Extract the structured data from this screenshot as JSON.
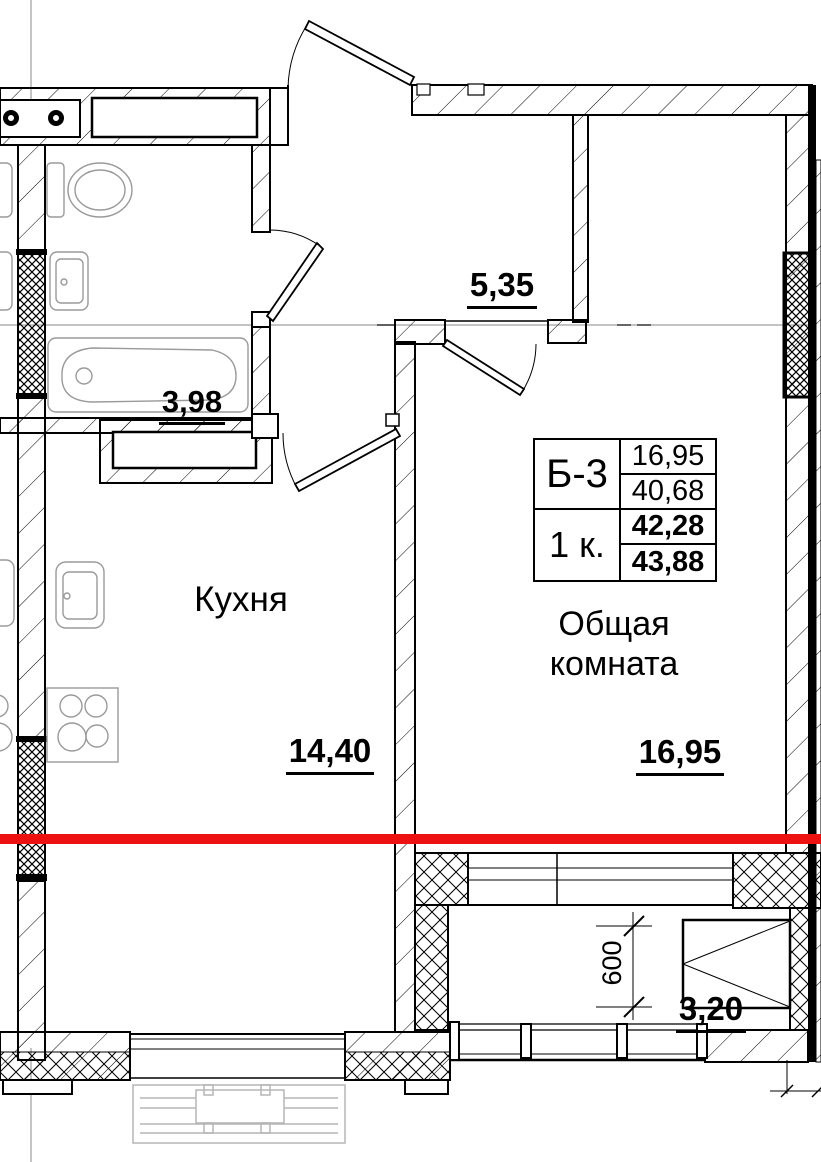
{
  "colors": {
    "red_line": "#ee1111",
    "wall_line": "#000000",
    "fixture_line": "#9a9a9a",
    "faint_detail": "#b5b5b5",
    "axis_line": "#8a8a8a"
  },
  "labels": {
    "hallway_area": "5,35",
    "bathroom_area": "3,98",
    "kitchen_name": "Кухня",
    "kitchen_area": "14,40",
    "living_room_name": "Общая комната",
    "living_room_area": "16,95",
    "balcony_area": "3,20",
    "balcony_depth_mm": "600"
  },
  "info_table": {
    "flat_type": "Б-3",
    "rooms_count": "1 к.",
    "values": [
      "16,95",
      "40,68",
      "42,28",
      "43,88"
    ]
  }
}
